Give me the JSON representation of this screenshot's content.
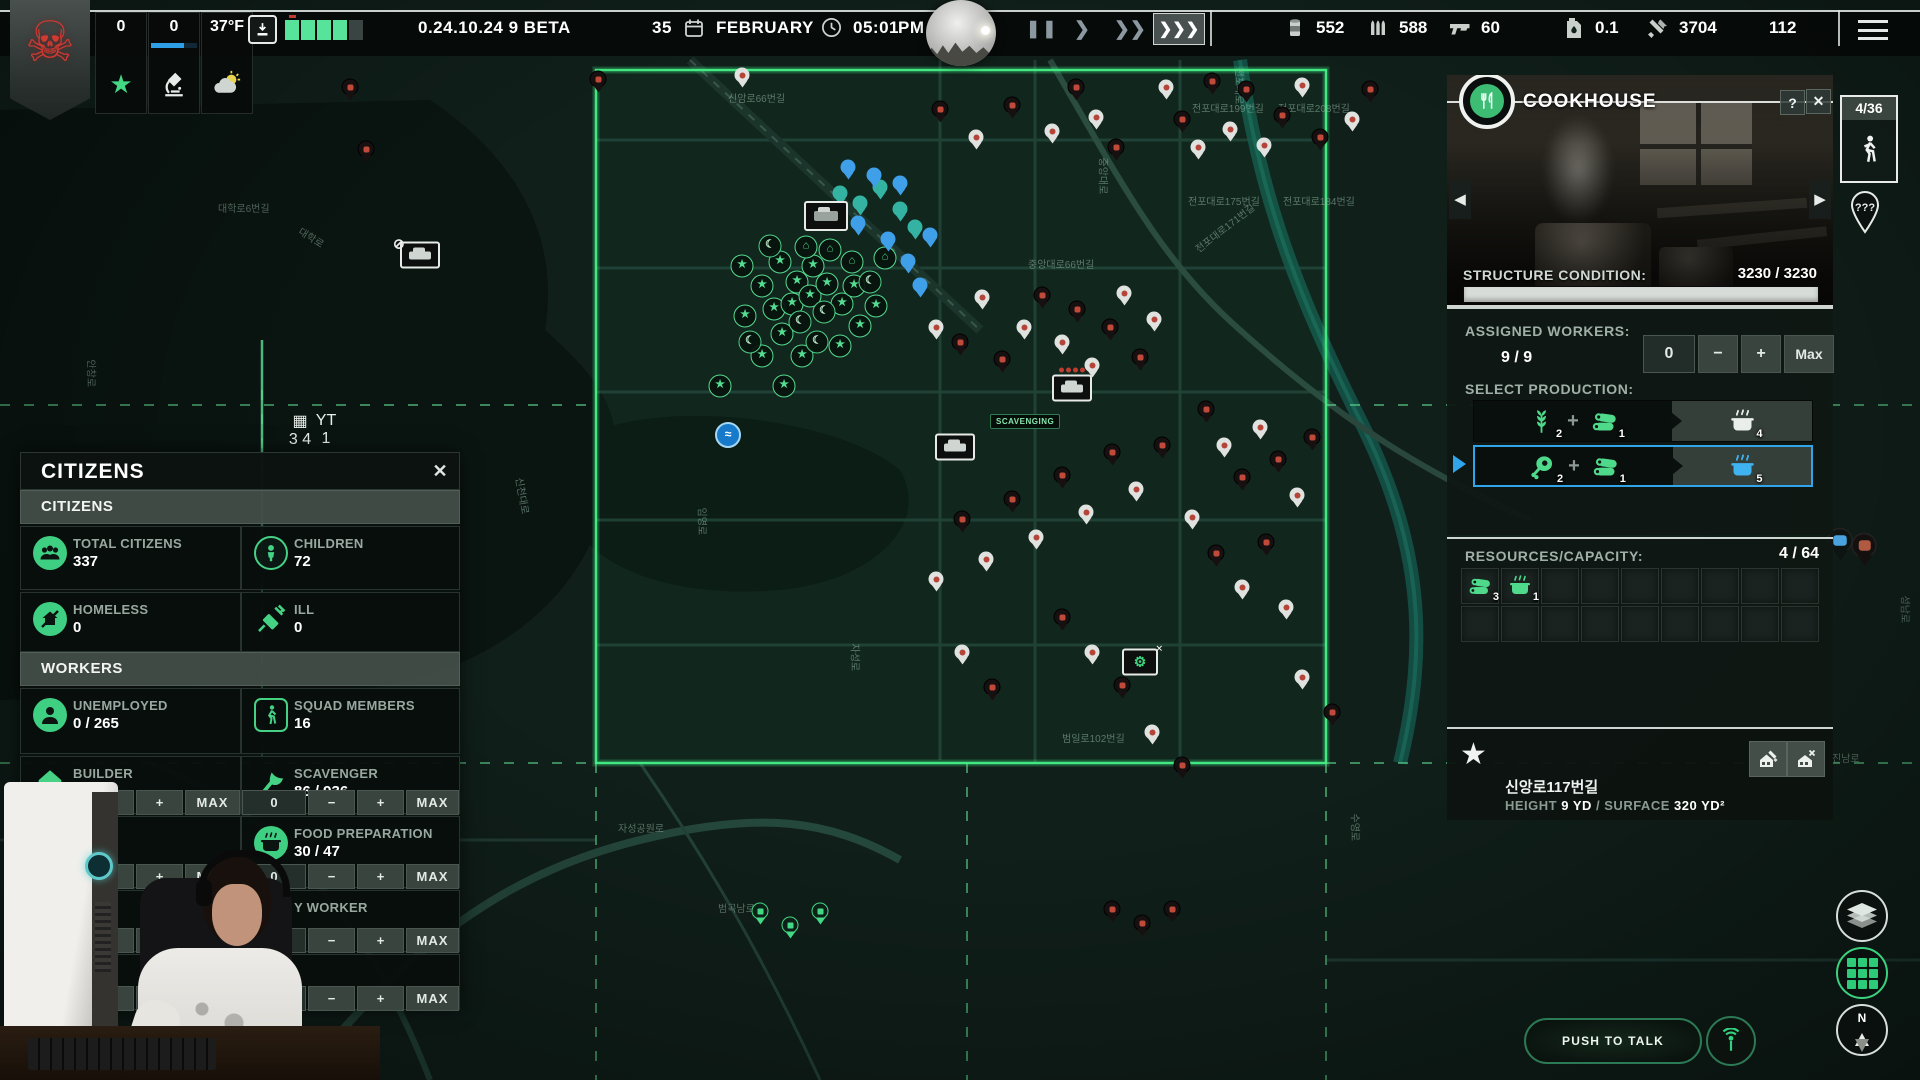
{
  "top_bar": {
    "version": "0.24.10.24 9 BETA",
    "date_day": "35",
    "date_month": "FEBRUARY",
    "time": "05:01",
    "meridiem": "PM",
    "temperature": "37°F",
    "star_count": "0",
    "research_count": "0",
    "resources": [
      {
        "icon": "canned-food",
        "value": "552"
      },
      {
        "icon": "ammo",
        "value": "588"
      },
      {
        "icon": "gun",
        "value": "60"
      },
      {
        "icon": "fuel",
        "value": "0.1"
      },
      {
        "icon": "tools",
        "value": "3704"
      },
      {
        "icon": "building-materials",
        "value": "112"
      }
    ]
  },
  "citizens_panel": {
    "title": "CITIZENS",
    "section_citizens": "CITIZENS",
    "section_workers": "WORKERS",
    "stats": [
      {
        "icon": "people",
        "style": "fcirc",
        "label": "TOTAL CITIZENS",
        "value": "337"
      },
      {
        "icon": "child",
        "style": "circ",
        "label": "CHILDREN",
        "value": "72"
      },
      {
        "icon": "homeless",
        "style": "fcirc",
        "label": "HOMELESS",
        "value": "0"
      },
      {
        "icon": "ill",
        "style": "bare",
        "label": "ILL",
        "value": "0"
      }
    ],
    "workers": [
      {
        "icon": "person",
        "style": "fcirc",
        "label": "UNEMPLOYED",
        "value": "0 / 265"
      },
      {
        "icon": "squad",
        "style": "rrect",
        "label": "SQUAD MEMBERS",
        "value": "16"
      },
      {
        "icon": "builder",
        "style": "bare",
        "label": "BUILDER",
        "value": "39 / 76"
      },
      {
        "icon": "axe",
        "style": "bare",
        "label": "SCAVENGER",
        "value": "86 / 936"
      },
      {
        "icon": "cookpot",
        "style": "fcirc",
        "label": "FOOD PREPARATION",
        "value": "30 / 47"
      },
      {
        "icon": "person",
        "style": "fcirc",
        "label": "Y WORKER",
        "value": ""
      }
    ],
    "buttons": {
      "zero": "0",
      "minus": "−",
      "plus": "+",
      "max": "MAX"
    }
  },
  "building_panel": {
    "title": "COOKHOUSE",
    "help": "?",
    "close": "✕",
    "occupancy": "4/36",
    "unknown_location": "???",
    "structure_condition_label": "STRUCTURE CONDITION:",
    "structure_condition_value": "3230 / 3230",
    "assigned_workers_label": "ASSIGNED WORKERS:",
    "assigned_workers_value": "9 / 9",
    "controls": {
      "value": "0",
      "minus": "−",
      "plus": "+",
      "max": "Max"
    },
    "select_production_label": "SELECT PRODUCTION:",
    "production_rows": [
      {
        "selected": false,
        "inputs": [
          {
            "icon": "wheat",
            "qty": "2"
          },
          {
            "icon": "logs",
            "qty": "1"
          }
        ],
        "output": {
          "icon": "cookpot",
          "qty": "4",
          "color": "white"
        }
      },
      {
        "selected": true,
        "inputs": [
          {
            "icon": "meat",
            "qty": "2"
          },
          {
            "icon": "logs",
            "qty": "1"
          }
        ],
        "output": {
          "icon": "cookpot",
          "qty": "5",
          "color": "blue"
        }
      }
    ],
    "resources_capacity_label": "RESOURCES/CAPACITY:",
    "resources_capacity_value": "4 / 64",
    "inventory_slots": 18,
    "inventory": [
      {
        "icon": "logs",
        "qty": "3"
      },
      {
        "icon": "cookpot",
        "qty": "1"
      }
    ],
    "address": "신앙로117번길",
    "height_label": "HEIGHT",
    "height_value": "9 YD",
    "surface_label": "SURFACE",
    "surface_value": "320 YD²"
  },
  "map": {
    "scavenging_label": "SCAVENGING",
    "mini_counts": [
      "3",
      "4",
      "1"
    ],
    "street_labels": [
      [
        "전포대로199번길",
        1192,
        100,
        0
      ],
      [
        "전포대로208번길",
        1278,
        100,
        0
      ],
      [
        "전포대로175번길",
        1188,
        193,
        0
      ],
      [
        "전포대로184번길",
        1283,
        193,
        0
      ],
      [
        "전포대로171번길",
        1196,
        242,
        -38
      ],
      [
        "신암로66번길",
        728,
        90,
        0
      ],
      [
        "중앙대로",
        1104,
        150,
        90
      ],
      [
        "중앙대로66번길",
        1028,
        256,
        0
      ],
      [
        "대학로",
        300,
        222,
        32
      ],
      [
        "대학로6번길",
        218,
        200,
        0
      ],
      [
        "안창로",
        92,
        352,
        90
      ],
      [
        "임영로",
        703,
        500,
        90
      ],
      [
        "자성로",
        856,
        636,
        90
      ],
      [
        "범곡남로",
        718,
        900,
        0
      ],
      [
        "범일로102번길",
        1062,
        730,
        0
      ],
      [
        "진남로",
        1832,
        750,
        0
      ],
      [
        "수영로",
        1356,
        806,
        90
      ],
      [
        "성남로",
        1906,
        588,
        90
      ],
      [
        "자성공원로",
        618,
        820,
        0
      ],
      [
        "신천대로",
        520,
        470,
        80
      ],
      [
        "전포대로",
        1240,
        60,
        90
      ]
    ],
    "markers": [
      [
        "gs",
        742,
        266
      ],
      [
        "gs",
        762,
        286
      ],
      [
        "gs",
        780,
        262
      ],
      [
        "gs",
        797,
        282
      ],
      [
        "gs",
        813,
        266
      ],
      [
        "gs",
        774,
        309
      ],
      [
        "gs",
        792,
        304
      ],
      [
        "gs",
        810,
        296
      ],
      [
        "gs",
        827,
        284
      ],
      [
        "gs",
        782,
        334
      ],
      [
        "gs",
        762,
        356
      ],
      [
        "gs",
        802,
        356
      ],
      [
        "gs",
        842,
        304
      ],
      [
        "gs",
        854,
        286
      ],
      [
        "gs",
        720,
        386
      ],
      [
        "gs",
        784,
        386
      ],
      [
        "gs",
        860,
        326
      ],
      [
        "gs",
        840,
        346
      ],
      [
        "gs",
        876,
        306
      ],
      [
        "gs",
        745,
        316
      ],
      [
        "gm",
        770,
        246
      ],
      [
        "gm",
        800,
        322
      ],
      [
        "gm",
        824,
        312
      ],
      [
        "gm",
        750,
        342
      ],
      [
        "gm",
        817,
        342
      ],
      [
        "gm",
        870,
        282
      ],
      [
        "gh",
        806,
        247
      ],
      [
        "gh",
        830,
        250
      ],
      [
        "gh",
        852,
        262
      ],
      [
        "gh",
        885,
        258
      ],
      [
        "tp",
        840,
        198
      ],
      [
        "tp",
        860,
        208
      ],
      [
        "tp",
        880,
        192
      ],
      [
        "tp",
        900,
        214
      ],
      [
        "tp",
        915,
        232
      ],
      [
        "bp",
        848,
        172
      ],
      [
        "bp",
        874,
        180
      ],
      [
        "bp",
        900,
        188
      ],
      [
        "bp",
        858,
        228
      ],
      [
        "bp",
        888,
        244
      ],
      [
        "bp",
        908,
        266
      ],
      [
        "bp",
        920,
        290
      ],
      [
        "bp",
        930,
        240
      ],
      [
        "camp",
        826,
        216
      ],
      [
        "caroff",
        420,
        255
      ],
      [
        "car",
        955,
        447
      ],
      [
        "truck",
        1072,
        388
      ],
      [
        "wrench",
        1140,
        662
      ],
      [
        "swirl",
        728,
        435
      ],
      [
        "mini1",
        300,
        430
      ],
      [
        "mini2",
        326,
        430
      ],
      [
        "lp",
        760,
        916
      ],
      [
        "lp",
        790,
        930
      ],
      [
        "lp",
        820,
        916
      ],
      [
        "rp",
        1112,
        914
      ],
      [
        "rp",
        1142,
        928
      ],
      [
        "rp",
        1172,
        914
      ],
      [
        "bigbp",
        1840,
        548
      ],
      [
        "bigrp",
        1864,
        553
      ],
      [
        "rp",
        350,
        92
      ],
      [
        "rp",
        366,
        154
      ],
      [
        "rp",
        598,
        84
      ],
      [
        "rp",
        940,
        114
      ],
      [
        "rp",
        1012,
        110
      ],
      [
        "rp",
        1076,
        92
      ],
      [
        "rp",
        1116,
        152
      ],
      [
        "rp",
        1182,
        124
      ],
      [
        "rp",
        1212,
        86
      ],
      [
        "rp",
        1246,
        94
      ],
      [
        "rp",
        1282,
        120
      ],
      [
        "rp",
        1320,
        142
      ],
      [
        "rp",
        1370,
        94
      ],
      [
        "rp",
        960,
        347
      ],
      [
        "rp",
        1002,
        364
      ],
      [
        "rp",
        1042,
        300
      ],
      [
        "rp",
        1077,
        314
      ],
      [
        "rp",
        1110,
        332
      ],
      [
        "rp",
        1140,
        362
      ],
      [
        "rp",
        1206,
        414
      ],
      [
        "rp",
        1242,
        482
      ],
      [
        "rp",
        1278,
        464
      ],
      [
        "rp",
        1312,
        442
      ],
      [
        "rp",
        1216,
        558
      ],
      [
        "rp",
        1266,
        547
      ],
      [
        "rp",
        1162,
        450
      ],
      [
        "rp",
        1112,
        457
      ],
      [
        "rp",
        1062,
        480
      ],
      [
        "rp",
        1012,
        504
      ],
      [
        "rp",
        962,
        524
      ],
      [
        "rp",
        1062,
        622
      ],
      [
        "rp",
        1122,
        690
      ],
      [
        "rp",
        992,
        692
      ],
      [
        "rp",
        1332,
        717
      ],
      [
        "rp",
        1182,
        770
      ],
      [
        "wp",
        742,
        80
      ],
      [
        "wp",
        976,
        142
      ],
      [
        "wp",
        1052,
        136
      ],
      [
        "wp",
        1096,
        122
      ],
      [
        "wp",
        1166,
        92
      ],
      [
        "wp",
        1198,
        152
      ],
      [
        "wp",
        1230,
        134
      ],
      [
        "wp",
        1264,
        150
      ],
      [
        "wp",
        1302,
        90
      ],
      [
        "wp",
        1352,
        124
      ],
      [
        "wp",
        936,
        332
      ],
      [
        "wp",
        982,
        302
      ],
      [
        "wp",
        1024,
        332
      ],
      [
        "wp",
        1062,
        347
      ],
      [
        "wp",
        1092,
        370
      ],
      [
        "wp",
        1124,
        298
      ],
      [
        "wp",
        1154,
        324
      ],
      [
        "wp",
        1224,
        450
      ],
      [
        "wp",
        1260,
        432
      ],
      [
        "wp",
        1297,
        500
      ],
      [
        "wp",
        1192,
        522
      ],
      [
        "wp",
        1242,
        592
      ],
      [
        "wp",
        1286,
        612
      ],
      [
        "wp",
        1136,
        494
      ],
      [
        "wp",
        1086,
        517
      ],
      [
        "wp",
        1036,
        542
      ],
      [
        "wp",
        986,
        564
      ],
      [
        "wp",
        936,
        584
      ],
      [
        "wp",
        1092,
        657
      ],
      [
        "wp",
        962,
        657
      ],
      [
        "wp",
        1302,
        682
      ],
      [
        "wp",
        1152,
        737
      ]
    ]
  },
  "hud": {
    "push_to_talk": "PUSH TO TALK",
    "compass": "N"
  }
}
